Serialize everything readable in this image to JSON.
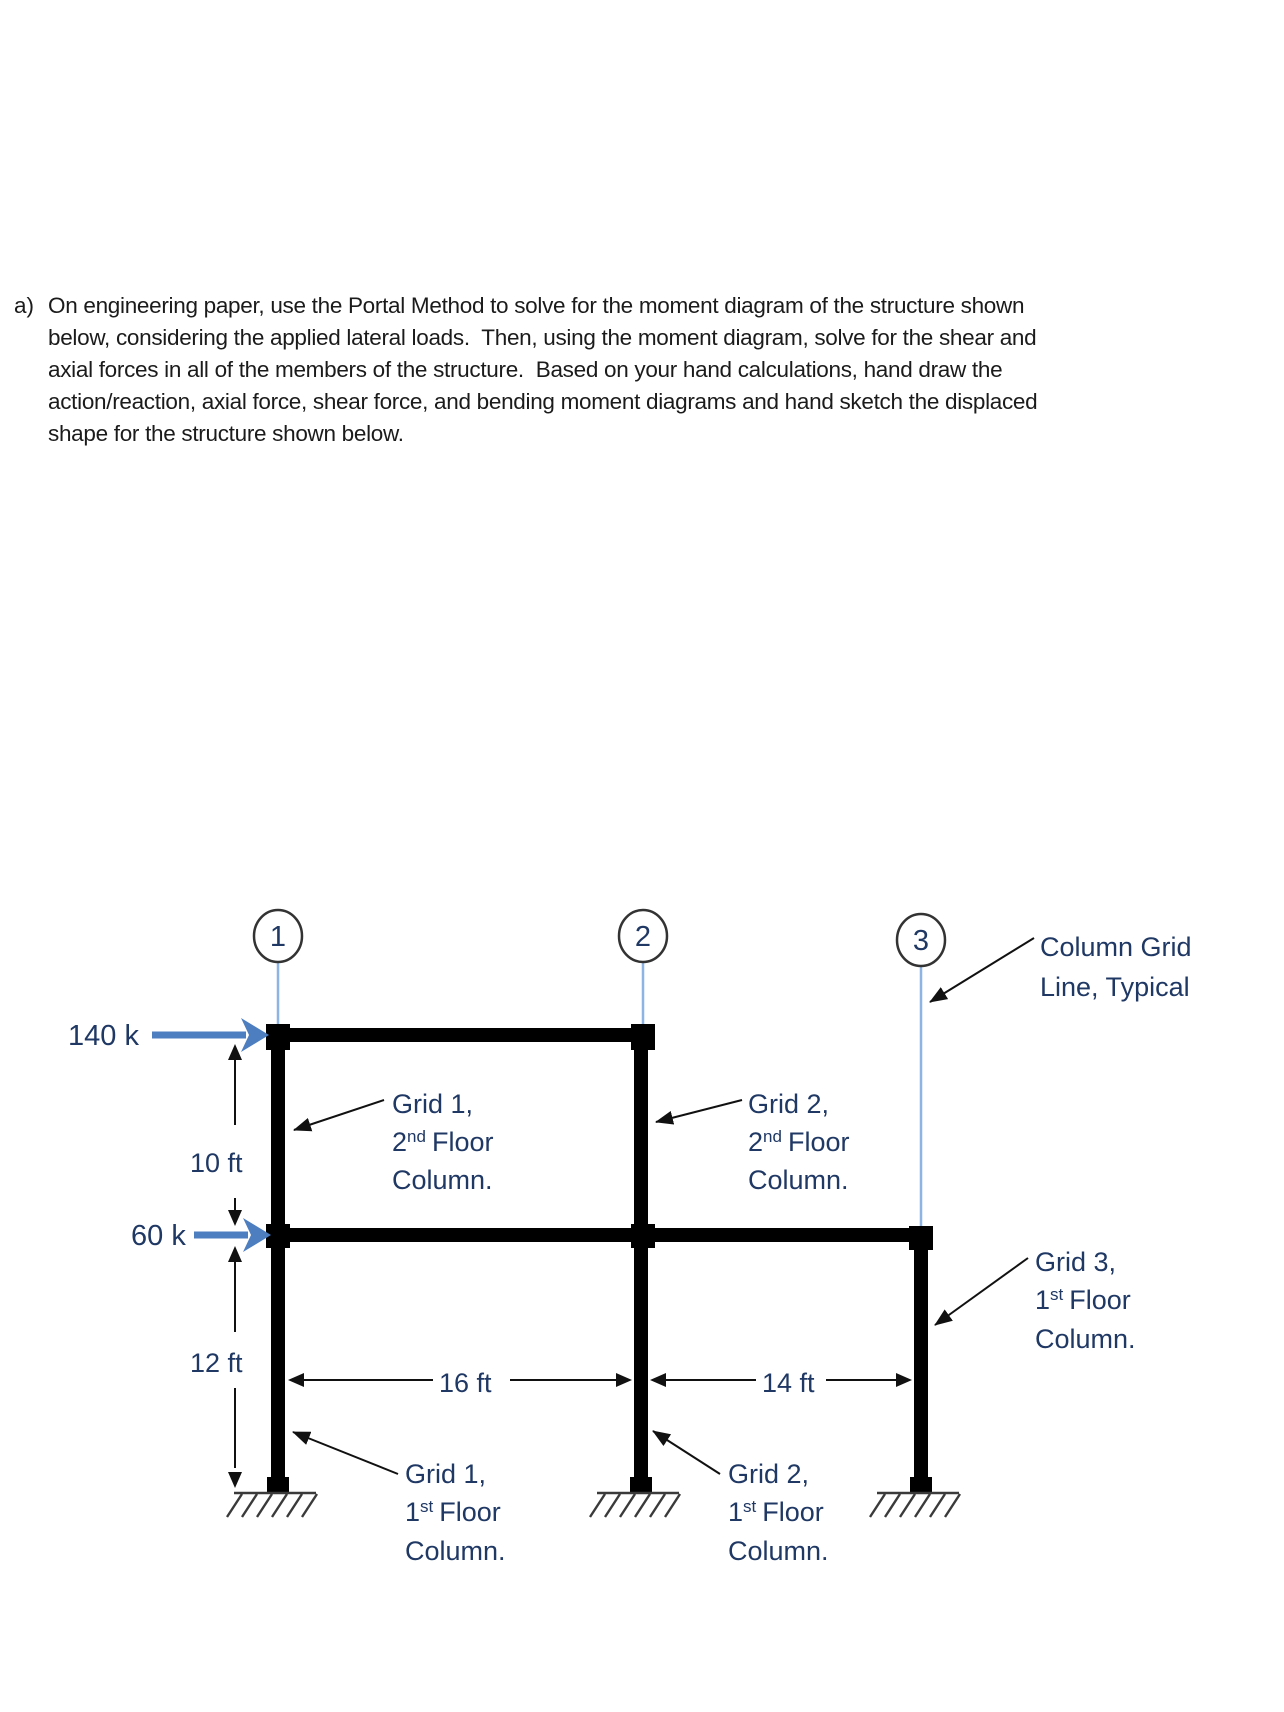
{
  "problem": {
    "marker": "a)",
    "lines": [
      "On engineering paper, use the Portal Method to solve for the moment diagram of the structure shown",
      "below, considering the applied lateral loads.  Then, using the moment diagram, solve for the shear and",
      "axial forces in all of the members of the structure.  Based on your hand calculations, hand draw the",
      "action/reaction, axial force, shear force, and bending moment diagrams and hand sketch the displaced",
      "shape for the structure shown below."
    ]
  },
  "diagram": {
    "grid_circles": [
      {
        "num": "1"
      },
      {
        "num": "2"
      },
      {
        "num": "3"
      }
    ],
    "loads": {
      "top": {
        "label": "140 k"
      },
      "mid": {
        "label": "60 k"
      }
    },
    "dims": {
      "h_upper": "10 ft",
      "h_lower": "12 ft",
      "bay1": "16 ft",
      "bay2": "14 ft"
    },
    "labels": {
      "grid_line_typical": {
        "line1": "Column Grid",
        "line2": "Line, Typical"
      },
      "g1f2": {
        "grid": "Grid 1,",
        "num": "2",
        "sup": "nd",
        "word": "Floor",
        "col": "Column."
      },
      "g2f2": {
        "grid": "Grid 2,",
        "num": "2",
        "sup": "nd",
        "word": "Floor",
        "col": "Column."
      },
      "g3f1": {
        "grid": "Grid 3,",
        "num": "1",
        "sup": "st",
        "word": "Floor",
        "col": "Column."
      },
      "g1f1": {
        "grid": "Grid 1,",
        "num": "1",
        "sup": "st",
        "word": "Floor",
        "col": "Column."
      },
      "g2f1": {
        "grid": "Grid 2,",
        "num": "1",
        "sup": "st",
        "word": "Floor",
        "col": "Column."
      }
    },
    "colors": {
      "load_arrow": "#4d7ebf",
      "grid_line": "#8eb4e3",
      "label_text": "#1f3864",
      "structure": "#000000",
      "ground": "#3a3a3a"
    }
  }
}
